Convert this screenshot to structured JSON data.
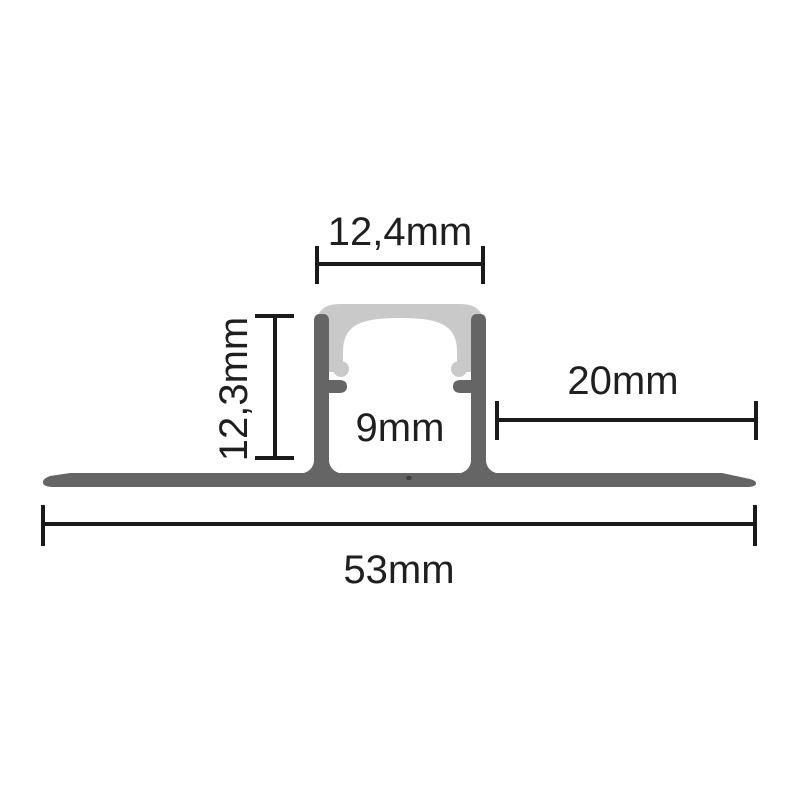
{
  "page": {
    "background": "#ffffff",
    "description": "Technical cross-section drawing of a recessed LED aluminium profile with diffuser cover and dimension annotations"
  },
  "colors": {
    "profile": "#656565",
    "diffuser": "#c9c9c9",
    "interior": "#ffffff",
    "dimension": "#1a1a1a",
    "text": "#1f1f1f",
    "spot": "#3f3f3f"
  },
  "labels": {
    "top_width": "12,4mm",
    "height": "12,3mm",
    "inner_width": "9mm",
    "flange_right": "20mm",
    "total_width": "53mm"
  }
}
